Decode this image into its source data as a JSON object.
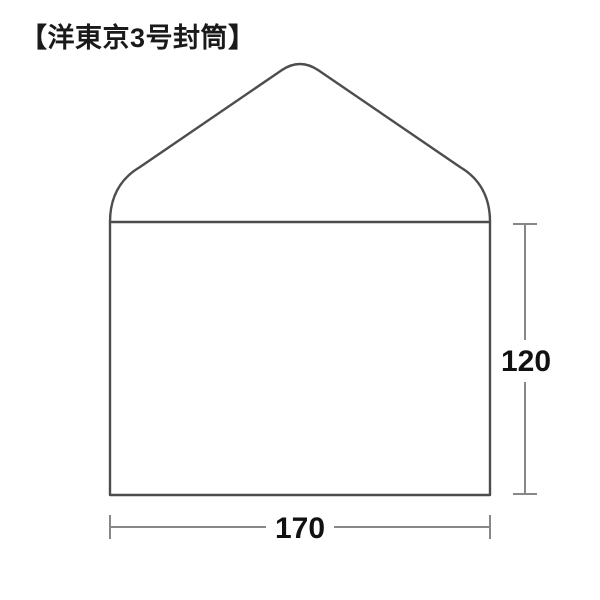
{
  "title": "【洋東京3号封筒】",
  "diagram": {
    "type": "envelope-dimension-diagram",
    "envelope_name": "洋東京3号封筒",
    "width_label": "170",
    "height_label": "120",
    "colors": {
      "outline": "#4d4d4d",
      "dimension": "#878787",
      "label_text": "#111111",
      "background": "#ffffff"
    }
  }
}
